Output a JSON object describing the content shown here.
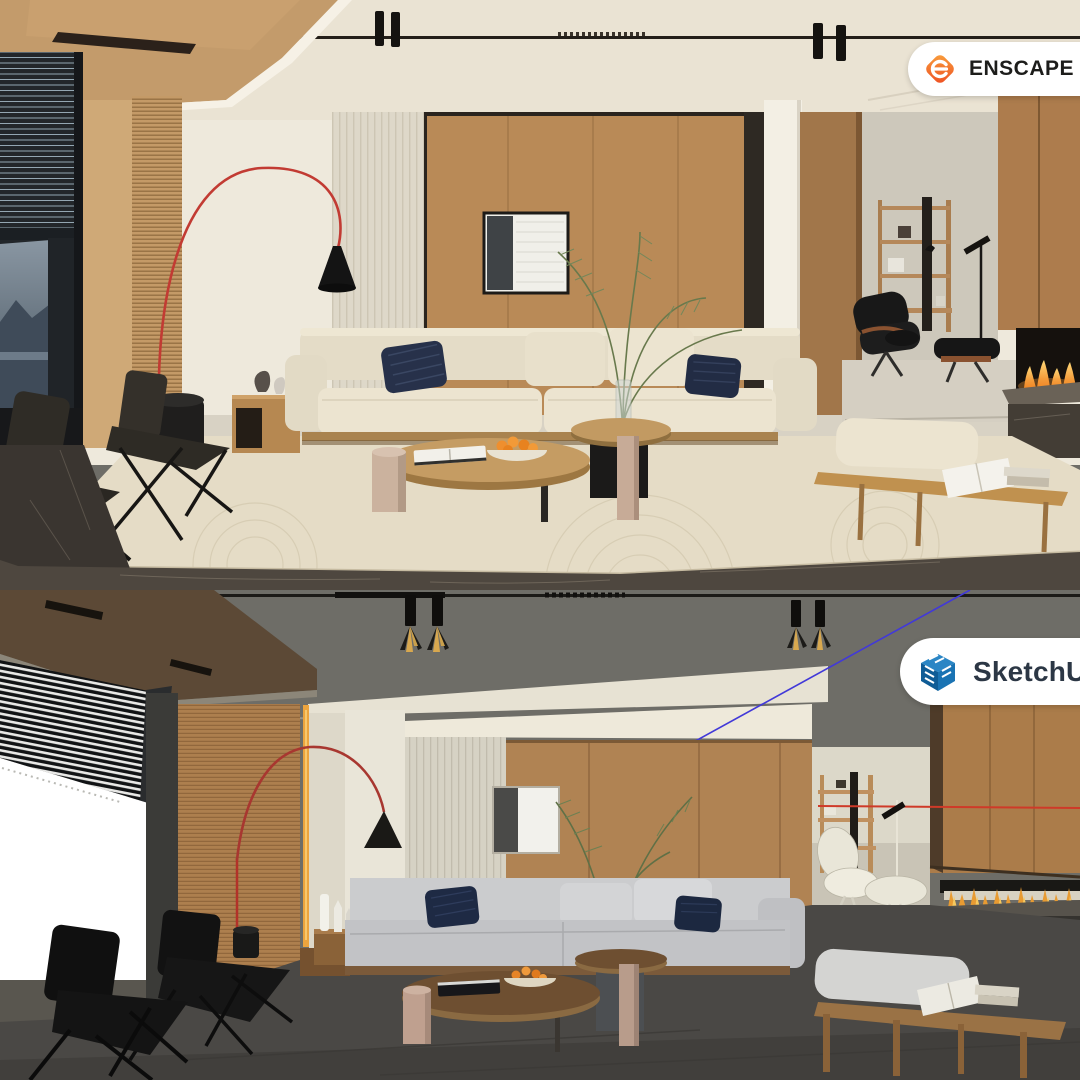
{
  "badges": {
    "enscape": {
      "label": "ENSCAPE",
      "trademark": "™",
      "pill_color": "#ffffff",
      "text_color": "#1d1d1b",
      "logo_orange_light": "#f9a13d",
      "logo_orange_dark": "#ee4d22"
    },
    "sketchup": {
      "label": "SketchUp",
      "pill_color": "#ffffff",
      "text_color": "#2c3745",
      "logo_blue": "#1a73b3"
    }
  },
  "scenes": {
    "top_render": {
      "palette": {
        "ceiling": "#eae3d3",
        "ceiling_wood": "#c39b6b",
        "wall_white": "#eee9dc",
        "wall_wood": "#b98a57",
        "fluted_panel": "#ded8c9",
        "window_view": "#5b6a77",
        "sofa_cream": "#e9e1cd",
        "pillow_navy": "#27314a",
        "rug": "#e5dcc6",
        "floor_marble": "#4e473f",
        "lamp_red": "#c23b33",
        "flame_orange": "#f07f1f"
      }
    },
    "bottom_model": {
      "palette": {
        "background_gray": "#6e6d67",
        "ceiling_beam": "#e7e2d3",
        "soffit_brown": "#5c4936",
        "wall_tan": "#b08353",
        "window_white": "#ffffff",
        "sofa_gray": "#c6c7c9",
        "pillow_navy": "#1e2a44",
        "floor_dark": "#4a4845",
        "guide_blue": "#4239d8",
        "axis_red": "#cf3a28",
        "lamp_red": "#a83730",
        "accent_yellow": "#eca43e"
      }
    }
  }
}
